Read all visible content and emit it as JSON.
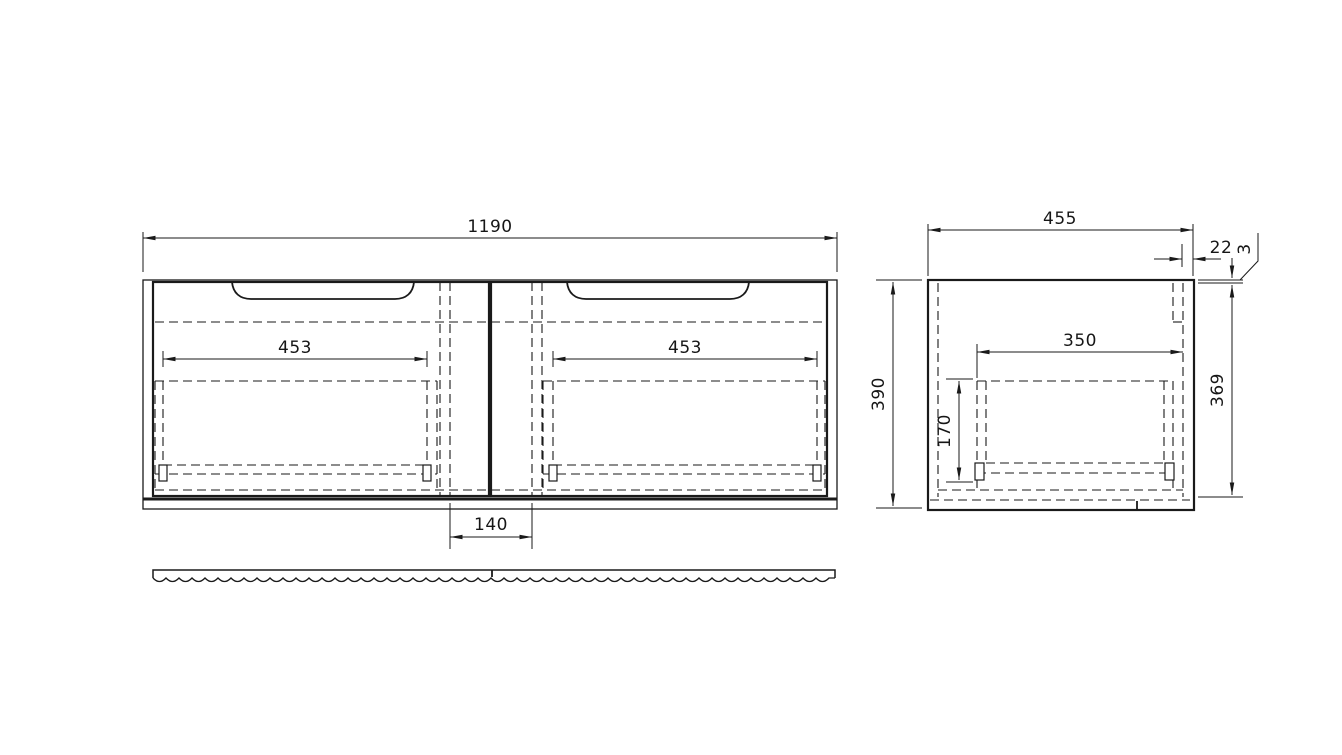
{
  "colors": {
    "line": "#1a1a1a",
    "background": "#ffffff"
  },
  "front_view": {
    "overall_width": "1190",
    "left_drawer_width": "453",
    "right_drawer_width": "453",
    "center_spacing": "140"
  },
  "side_view": {
    "depth": "455",
    "back_panel_offset": "22",
    "top_edge_thickness": "3",
    "height": "390",
    "inner_depth": "350",
    "drawer_opening_height": "170",
    "inner_height": "369"
  }
}
